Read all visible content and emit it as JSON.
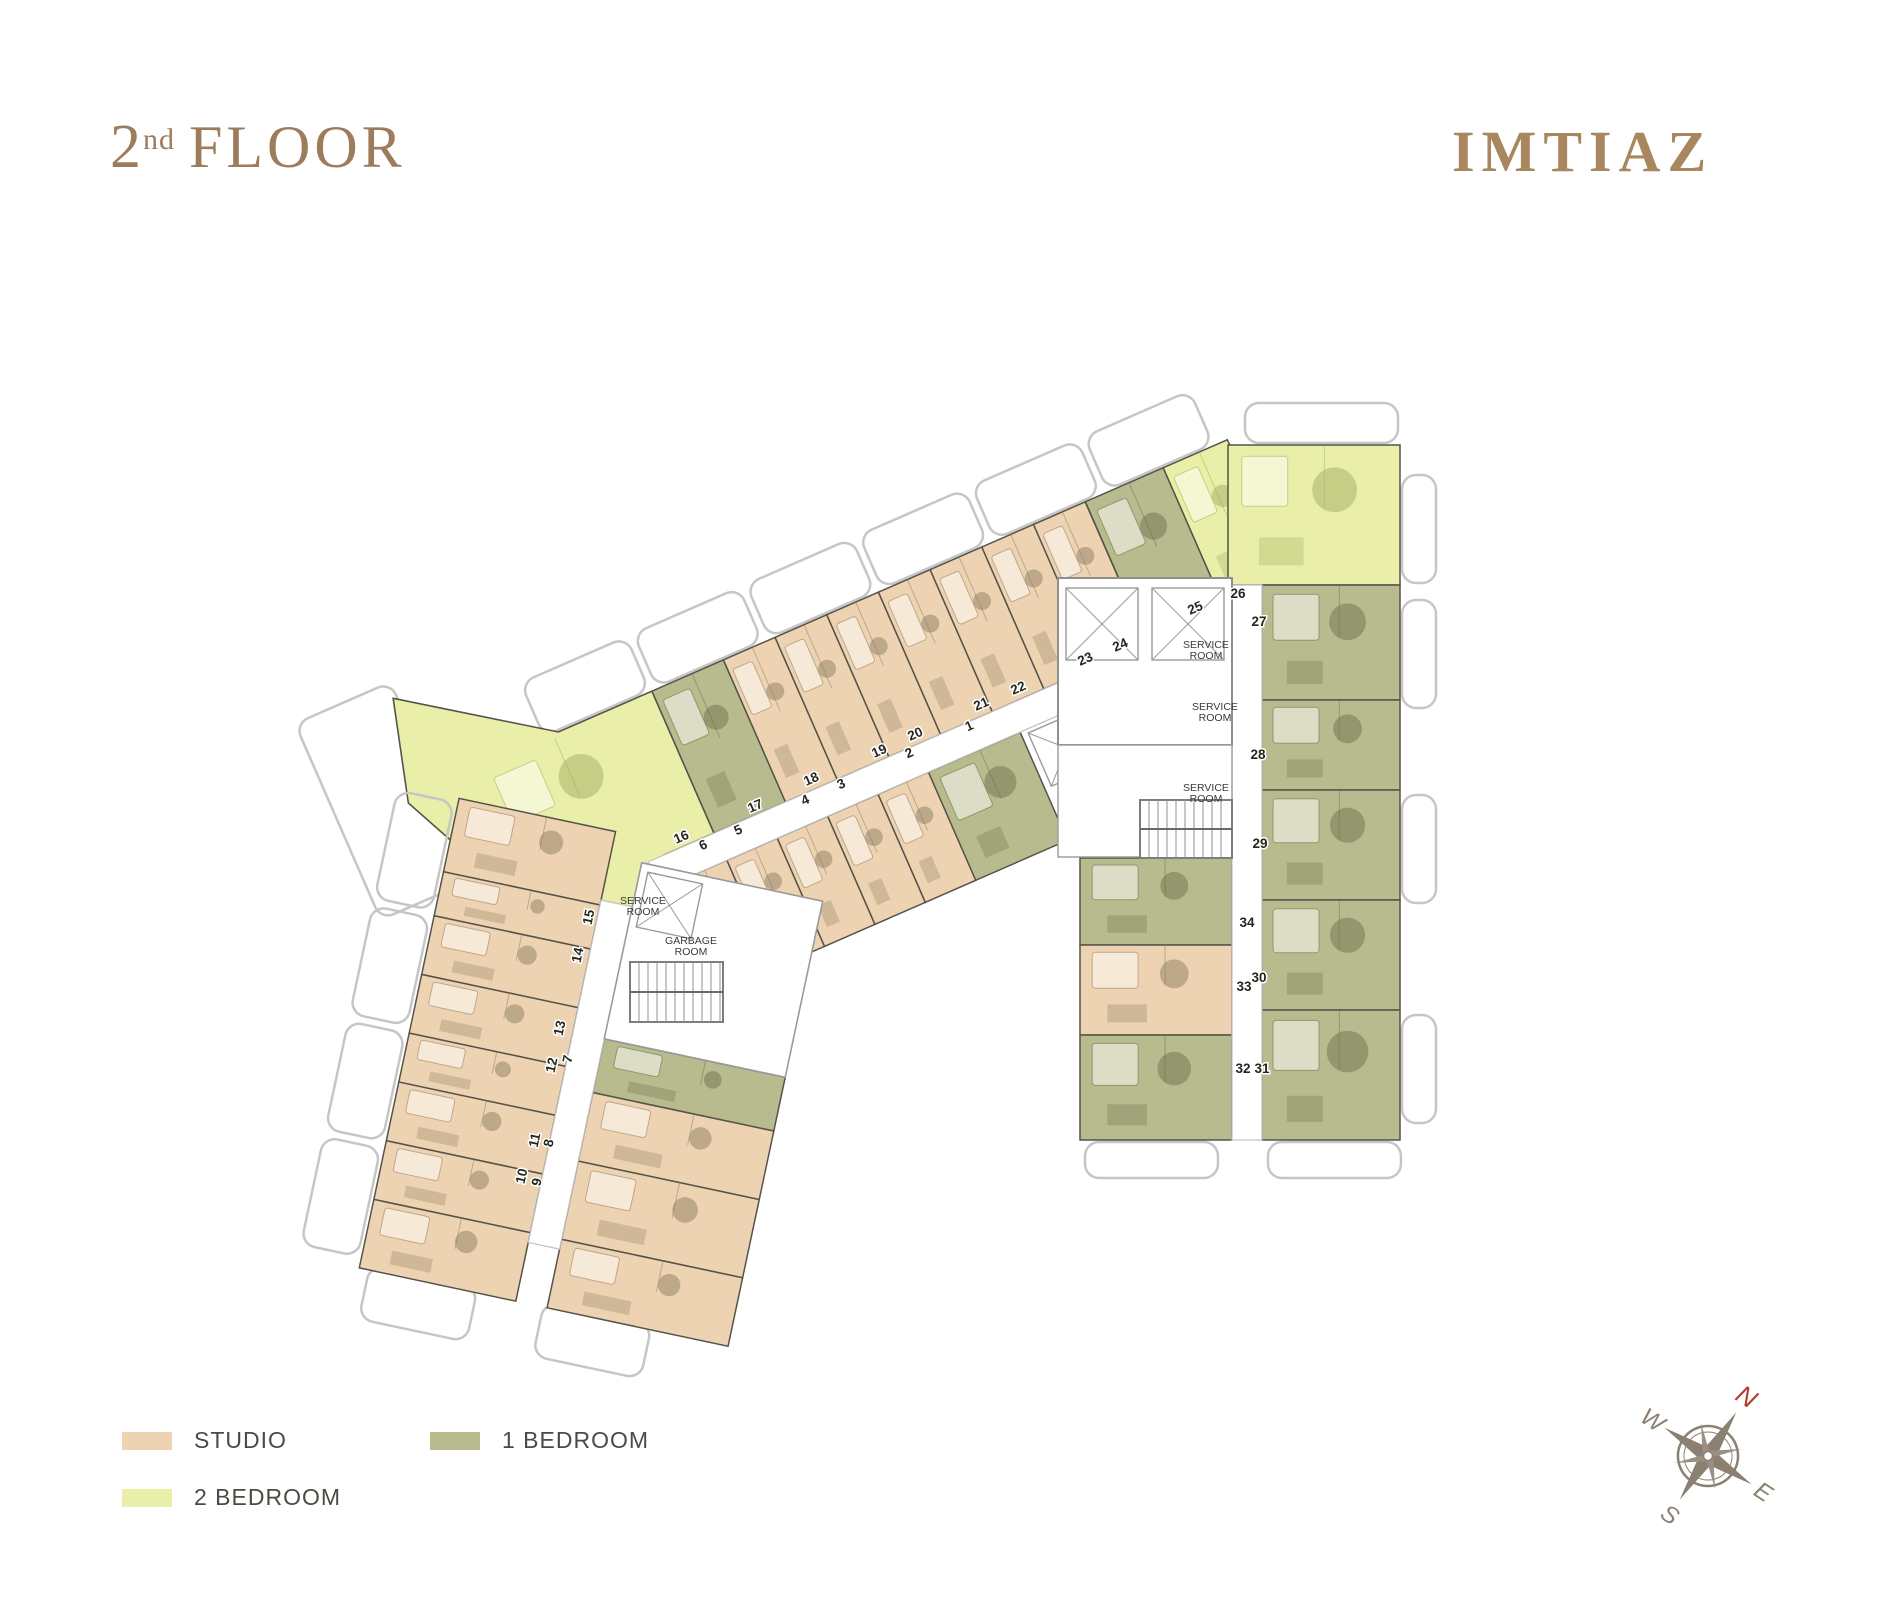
{
  "header": {
    "title_number": "2",
    "title_superscript": "nd",
    "title_word": "FLOOR",
    "brand": "IMTIAZ"
  },
  "legend": [
    {
      "label": "STUDIO",
      "key": "studio"
    },
    {
      "label": "2 BEDROOM",
      "key": "two_bedroom"
    },
    {
      "label": "1 BEDROOM",
      "key": "one_bedroom"
    }
  ],
  "compass": {
    "n": "N",
    "e": "E",
    "s": "S",
    "w": "W",
    "north_color": "#b23b2e",
    "body_color": "#8b8071"
  },
  "floor_plan": {
    "palette": {
      "studio": "#eed3b2",
      "one_bedroom": "#b7bb8e",
      "two_bedroom": "#e9efa8",
      "studio_dark": "#8d7e62",
      "one_bedroom_dark": "#6e734d",
      "two_bedroom_dark": "#a3ad62",
      "walls": "#55534a",
      "balcony": "#c6c6c6",
      "core_gray": "#8f8f8f",
      "corridor_line": "#c2c2c2",
      "label_color": "#26261f"
    },
    "room_labels": [
      {
        "text": "SERVICE ROOM",
        "x": 1206,
        "y": 648
      },
      {
        "text": "SERVICE ROOM",
        "x": 1215,
        "y": 710
      },
      {
        "text": "SERVICE ROOM",
        "x": 1206,
        "y": 791
      },
      {
        "text": "SERVICE ROOM",
        "x": 643,
        "y": 904
      },
      {
        "text": "GARBAGE ROOM",
        "x": 691,
        "y": 944
      }
    ],
    "units": [
      {
        "no": "1",
        "type": "1br",
        "x": 971,
        "y": 730,
        "rot": -24
      },
      {
        "no": "2",
        "type": "studio",
        "x": 911,
        "y": 757,
        "rot": -24
      },
      {
        "no": "3",
        "type": "studio",
        "x": 843,
        "y": 788,
        "rot": -24
      },
      {
        "no": "4",
        "type": "studio",
        "x": 807,
        "y": 804,
        "rot": -24
      },
      {
        "no": "5",
        "type": "studio",
        "x": 740,
        "y": 834,
        "rot": -24
      },
      {
        "no": "6",
        "type": "studio",
        "x": 705,
        "y": 849,
        "rot": -24
      },
      {
        "no": "7",
        "type": "1br",
        "x": 572,
        "y": 1060,
        "rot": -78
      },
      {
        "no": "8",
        "type": "studio",
        "x": 553,
        "y": 1144,
        "rot": -78
      },
      {
        "no": "9",
        "type": "studio",
        "x": 541,
        "y": 1183,
        "rot": -78
      },
      {
        "no": "10",
        "type": "studio",
        "x": 526,
        "y": 1177,
        "rot": -78
      },
      {
        "no": "11",
        "type": "studio",
        "x": 539,
        "y": 1141,
        "rot": -78
      },
      {
        "no": "12",
        "type": "studio",
        "x": 556,
        "y": 1066,
        "rot": -78
      },
      {
        "no": "13",
        "type": "studio",
        "x": 564,
        "y": 1029,
        "rot": -78
      },
      {
        "no": "14",
        "type": "studio",
        "x": 582,
        "y": 956,
        "rot": -78
      },
      {
        "no": "15",
        "type": "studio",
        "x": 593,
        "y": 918,
        "rot": -78
      },
      {
        "no": "16",
        "type": "2br",
        "x": 683,
        "y": 841,
        "rot": -24
      },
      {
        "no": "17",
        "type": "1br",
        "x": 757,
        "y": 810,
        "rot": -24
      },
      {
        "no": "18",
        "type": "studio",
        "x": 813,
        "y": 783,
        "rot": -24
      },
      {
        "no": "19",
        "type": "studio",
        "x": 881,
        "y": 755,
        "rot": -24
      },
      {
        "no": "20",
        "type": "studio",
        "x": 917,
        "y": 738,
        "rot": -24
      },
      {
        "no": "21",
        "type": "studio",
        "x": 983,
        "y": 708,
        "rot": -24
      },
      {
        "no": "22",
        "type": "studio",
        "x": 1020,
        "y": 692,
        "rot": -24
      },
      {
        "no": "23",
        "type": "studio",
        "x": 1087,
        "y": 663,
        "rot": -24
      },
      {
        "no": "24",
        "type": "studio",
        "x": 1122,
        "y": 649,
        "rot": -24
      },
      {
        "no": "25",
        "type": "1br",
        "x": 1197,
        "y": 612,
        "rot": -24
      },
      {
        "no": "26",
        "type": "2br",
        "x": 1238,
        "y": 598,
        "rot": 0
      },
      {
        "no": "27",
        "type": "1br",
        "x": 1259,
        "y": 626,
        "rot": 0
      },
      {
        "no": "28",
        "type": "1br",
        "x": 1258,
        "y": 759,
        "rot": 0
      },
      {
        "no": "29",
        "type": "1br",
        "x": 1260,
        "y": 848,
        "rot": 0
      },
      {
        "no": "30",
        "type": "1br",
        "x": 1259,
        "y": 982,
        "rot": 0
      },
      {
        "no": "31",
        "type": "1br",
        "x": 1262,
        "y": 1073,
        "rot": 0
      },
      {
        "no": "32",
        "type": "1br",
        "x": 1243,
        "y": 1073,
        "rot": 0
      },
      {
        "no": "33",
        "type": "studio",
        "x": 1244,
        "y": 991,
        "rot": 0
      },
      {
        "no": "34",
        "type": "1br",
        "x": 1247,
        "y": 927,
        "rot": 0
      }
    ]
  }
}
